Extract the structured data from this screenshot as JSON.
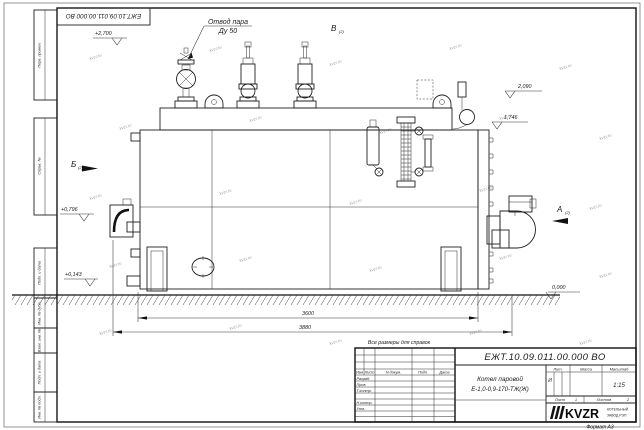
{
  "sheet": {
    "format": "Формат А3",
    "watermark": "kvzr.ru"
  },
  "top_stamp": {
    "doc_number": "ЕЖТ.10.09.011.00.000  ВО"
  },
  "margin_fields": {
    "perv_primen": "Перв. примен.",
    "sprav_no": "Справ. №",
    "podp_data_1": "Подп. и дата",
    "inv_dubl": "Инв. № дубл.",
    "vzam_inv": "Взам. инв. №",
    "podp_data_2": "Подп. и дата",
    "inv_podl": "Инв. № подл."
  },
  "callouts": {
    "steam_outlet": "Отвод пара",
    "steam_outlet_dn": "Ду 50"
  },
  "views": {
    "v_label": "В",
    "b_label": "Б",
    "a_label": "А",
    "sheet_ref": "(2)"
  },
  "elevations": {
    "top": "+2,700",
    "deck": "2,090",
    "mid": "1,746",
    "front": "+0,796",
    "low": "+0,143",
    "ground": "0,000"
  },
  "dimensions": {
    "length_3600": "3600",
    "length_3880": "3880"
  },
  "note": "Все размеры для справок",
  "title_block": {
    "doc_number": "ЕЖТ.10.09.011.00.000  ВО",
    "product_line1": "Котел паровой",
    "product_line2": "Е-1,0-0,9-170-ТЖ(Ж)",
    "col_izm": "Изм",
    "col_list": "Лист",
    "col_ndokum": "N докум.",
    "col_podp": "Подп.",
    "col_data": "Дата",
    "row_razrab": "Разраб.",
    "row_prov": "Пров.",
    "row_tkontr": "Т.контр.",
    "row_nkontr": "Н.контр.",
    "row_utv": "Утв.",
    "lit_header": "Лит.",
    "mass_header": "Масса",
    "scale_header": "Масштаб",
    "lit_value": "И",
    "scale_value": "1:15",
    "sheet_label": "Лист",
    "sheet_value": "1",
    "sheets_label": "Листов",
    "sheets_value": "2",
    "logo": "KVZR",
    "logo_caption1": "КОТЕЛЬНЫЙ",
    "logo_caption2": "ЗАВОД РЭП"
  }
}
